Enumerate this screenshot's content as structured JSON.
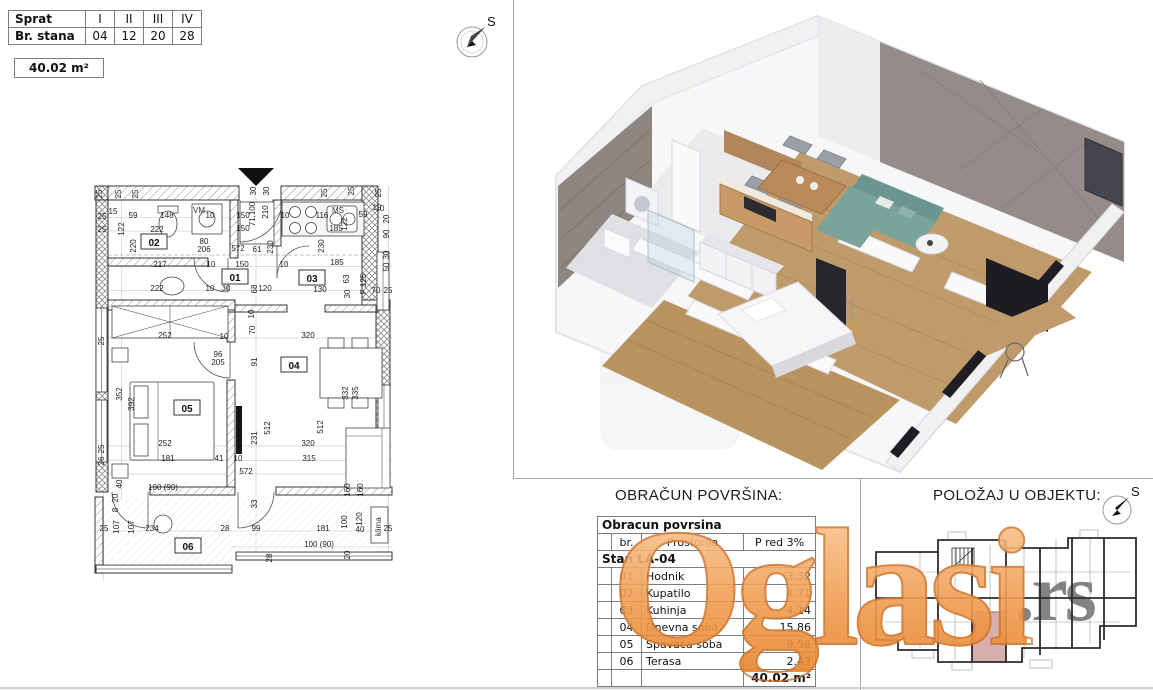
{
  "header": {
    "floor_table": {
      "rows": [
        {
          "label": "Sprat",
          "values": [
            "I",
            "II",
            "III",
            "IV"
          ]
        },
        {
          "label": "Br. stana",
          "values": [
            "04",
            "12",
            "20",
            "28"
          ]
        }
      ]
    },
    "area_badge": "40.02 m²"
  },
  "compass": {
    "label": "S"
  },
  "floor_plan": {
    "rooms": [
      {
        "id": "01",
        "x": 235,
        "y": 279
      },
      {
        "id": "02",
        "x": 154,
        "y": 244
      },
      {
        "id": "03",
        "x": 312,
        "y": 280
      },
      {
        "id": "04",
        "x": 294,
        "y": 367
      },
      {
        "id": "05",
        "x": 187,
        "y": 410
      },
      {
        "id": "06",
        "x": 188,
        "y": 548
      }
    ],
    "fixtures": {
      "washing_machine": "VM",
      "kitchen_sink": "MS",
      "ac_unit": "klima"
    },
    "dimensions": [
      {
        "t": "25",
        "x": 102,
        "y": 194,
        "r": 1
      },
      {
        "t": "15",
        "x": 113,
        "y": 214
      },
      {
        "t": "25",
        "x": 121,
        "y": 194,
        "r": 1
      },
      {
        "t": "25",
        "x": 138,
        "y": 194,
        "r": 1
      },
      {
        "t": "59",
        "x": 133,
        "y": 218
      },
      {
        "t": "148",
        "x": 167,
        "y": 218
      },
      {
        "t": "10",
        "x": 210,
        "y": 218
      },
      {
        "t": "150",
        "x": 243,
        "y": 218
      },
      {
        "t": "30",
        "x": 256,
        "y": 191,
        "r": 1
      },
      {
        "t": "30",
        "x": 269,
        "y": 191,
        "r": 1
      },
      {
        "t": "71,100",
        "x": 255,
        "y": 214,
        "r": 1
      },
      {
        "t": "210",
        "x": 268,
        "y": 212,
        "r": 1
      },
      {
        "t": "10",
        "x": 285,
        "y": 218
      },
      {
        "t": "116",
        "x": 322,
        "y": 218
      },
      {
        "t": "59",
        "x": 363,
        "y": 217
      },
      {
        "t": "10",
        "x": 380,
        "y": 211
      },
      {
        "t": "25",
        "x": 327,
        "y": 193,
        "r": 1
      },
      {
        "t": "25",
        "x": 354,
        "y": 191,
        "r": 1
      },
      {
        "t": "25",
        "x": 381,
        "y": 193,
        "r": 1
      },
      {
        "t": "122",
        "x": 124,
        "y": 229,
        "r": 1
      },
      {
        "t": "220",
        "x": 136,
        "y": 246,
        "r": 1
      },
      {
        "t": "222",
        "x": 157,
        "y": 232
      },
      {
        "t": "150",
        "x": 243,
        "y": 231
      },
      {
        "t": "122",
        "x": 347,
        "y": 224,
        "r": 1
      },
      {
        "t": "185",
        "x": 336,
        "y": 231
      },
      {
        "t": "19",
        "x": 377,
        "y": 210
      },
      {
        "t": "20",
        "x": 389,
        "y": 219,
        "r": 1
      },
      {
        "t": "90",
        "x": 389,
        "y": 234,
        "r": 1
      },
      {
        "t": "25",
        "x": 102,
        "y": 219
      },
      {
        "t": "25",
        "x": 102,
        "y": 232
      },
      {
        "t": "80",
        "x": 204,
        "y": 244
      },
      {
        "t": "206",
        "x": 204,
        "y": 252
      },
      {
        "t": "572",
        "x": 238,
        "y": 251
      },
      {
        "t": "61",
        "x": 257,
        "y": 252
      },
      {
        "t": "230",
        "x": 273,
        "y": 247,
        "r": 1
      },
      {
        "t": "230",
        "x": 324,
        "y": 246,
        "r": 1
      },
      {
        "t": "30",
        "x": 389,
        "y": 255,
        "r": 1
      },
      {
        "t": "217",
        "x": 160,
        "y": 267
      },
      {
        "t": "10",
        "x": 211,
        "y": 267
      },
      {
        "t": "150",
        "x": 242,
        "y": 267
      },
      {
        "t": "10",
        "x": 284,
        "y": 267
      },
      {
        "t": "185",
        "x": 337,
        "y": 265
      },
      {
        "t": "50",
        "x": 389,
        "y": 267,
        "r": 1
      },
      {
        "t": "222",
        "x": 157,
        "y": 291
      },
      {
        "t": "10",
        "x": 210,
        "y": 291
      },
      {
        "t": "30",
        "x": 226,
        "y": 291
      },
      {
        "t": "68",
        "x": 257,
        "y": 289,
        "r": 1
      },
      {
        "t": "120",
        "x": 265,
        "y": 291
      },
      {
        "t": "130",
        "x": 320,
        "y": 292
      },
      {
        "t": "63",
        "x": 349,
        "y": 279,
        "r": 1
      },
      {
        "t": "F 125",
        "x": 366,
        "y": 284,
        "r": 1
      },
      {
        "t": "70",
        "x": 376,
        "y": 293
      },
      {
        "t": "25",
        "x": 388,
        "y": 293
      },
      {
        "t": "30",
        "x": 350,
        "y": 294,
        "r": 1
      },
      {
        "t": "10",
        "x": 254,
        "y": 314,
        "r": 1
      },
      {
        "t": "70",
        "x": 255,
        "y": 330,
        "r": 1
      },
      {
        "t": "252",
        "x": 165,
        "y": 338
      },
      {
        "t": "10",
        "x": 224,
        "y": 339
      },
      {
        "t": "320",
        "x": 308,
        "y": 338
      },
      {
        "t": "91",
        "x": 257,
        "y": 362,
        "r": 1
      },
      {
        "t": "96",
        "x": 218,
        "y": 357
      },
      {
        "t": "205",
        "x": 218,
        "y": 365
      },
      {
        "t": "25",
        "x": 104,
        "y": 341,
        "r": 1
      },
      {
        "t": "352",
        "x": 122,
        "y": 394,
        "r": 1
      },
      {
        "t": "392",
        "x": 134,
        "y": 404,
        "r": 1
      },
      {
        "t": "512",
        "x": 270,
        "y": 428,
        "r": 1
      },
      {
        "t": "512",
        "x": 323,
        "y": 427,
        "r": 1
      },
      {
        "t": "231",
        "x": 257,
        "y": 438,
        "r": 1
      },
      {
        "t": "332",
        "x": 348,
        "y": 393,
        "r": 1
      },
      {
        "t": "335",
        "x": 358,
        "y": 393,
        "r": 1
      },
      {
        "t": "252",
        "x": 165,
        "y": 446
      },
      {
        "t": "320",
        "x": 308,
        "y": 446
      },
      {
        "t": "25",
        "x": 104,
        "y": 449,
        "r": 1
      },
      {
        "t": "26",
        "x": 104,
        "y": 461,
        "r": 1
      },
      {
        "t": "181",
        "x": 168,
        "y": 461
      },
      {
        "t": "41",
        "x": 219,
        "y": 461
      },
      {
        "t": "10",
        "x": 238,
        "y": 461
      },
      {
        "t": "315",
        "x": 309,
        "y": 461
      },
      {
        "t": "572",
        "x": 246,
        "y": 474
      },
      {
        "t": "40",
        "x": 122,
        "y": 484,
        "r": 1
      },
      {
        "t": "100 (90)",
        "x": 163,
        "y": 490
      },
      {
        "t": "33",
        "x": 257,
        "y": 504,
        "r": 1
      },
      {
        "t": "160",
        "x": 350,
        "y": 490,
        "r": 1
      },
      {
        "t": "160",
        "x": 363,
        "y": 490,
        "r": 1
      },
      {
        "t": "20",
        "x": 118,
        "y": 498,
        "r": 1
      },
      {
        "t": "8",
        "x": 118,
        "y": 510,
        "r": 1
      },
      {
        "t": "107",
        "x": 119,
        "y": 527,
        "r": 1
      },
      {
        "t": "107",
        "x": 134,
        "y": 527,
        "r": 1
      },
      {
        "t": "234",
        "x": 152,
        "y": 531
      },
      {
        "t": "28",
        "x": 225,
        "y": 531
      },
      {
        "t": "99",
        "x": 256,
        "y": 531
      },
      {
        "t": "181",
        "x": 323,
        "y": 531
      },
      {
        "t": "100",
        "x": 347,
        "y": 522,
        "r": 1
      },
      {
        "t": "120",
        "x": 362,
        "y": 519,
        "r": 1
      },
      {
        "t": "40",
        "x": 360,
        "y": 532
      },
      {
        "t": "25",
        "x": 388,
        "y": 531
      },
      {
        "t": "25",
        "x": 104,
        "y": 531
      },
      {
        "t": "100 (90)",
        "x": 319,
        "y": 547
      },
      {
        "t": "28",
        "x": 272,
        "y": 558,
        "r": 1
      },
      {
        "t": "20",
        "x": 350,
        "y": 555,
        "r": 1
      }
    ]
  },
  "area_table": {
    "title": "OBRAČUN POVRŠINA:",
    "header": "Obracun povrsina",
    "columns": [
      "br.",
      "Prostorija",
      "P red 3%"
    ],
    "subheader": "Stan LA-04",
    "rows": [
      [
        "01",
        "Hodnik",
        "3.32"
      ],
      [
        "02",
        "Kupatilo",
        "4.71"
      ],
      [
        "03",
        "Kuhinja",
        "4.14"
      ],
      [
        "04",
        "Dnevna soba",
        "15.86"
      ],
      [
        "05",
        "Spavaca soba",
        "9.56"
      ],
      [
        "06",
        "Terasa",
        "2.43"
      ]
    ],
    "total": "40.02 m²"
  },
  "position_section": {
    "title": "POLOŽAJ U OBJEKTU:",
    "compass_label": "S"
  },
  "watermark": {
    "text": "Oglasi",
    "suffix": ".rs",
    "orange": "#f0a055",
    "gray": "#636363"
  },
  "colors": {
    "highlight_unit": "#d9aeae",
    "accent_wall": "#958c89",
    "wood_floor": "#bf9a6b",
    "sofa": "#7aa39c"
  }
}
